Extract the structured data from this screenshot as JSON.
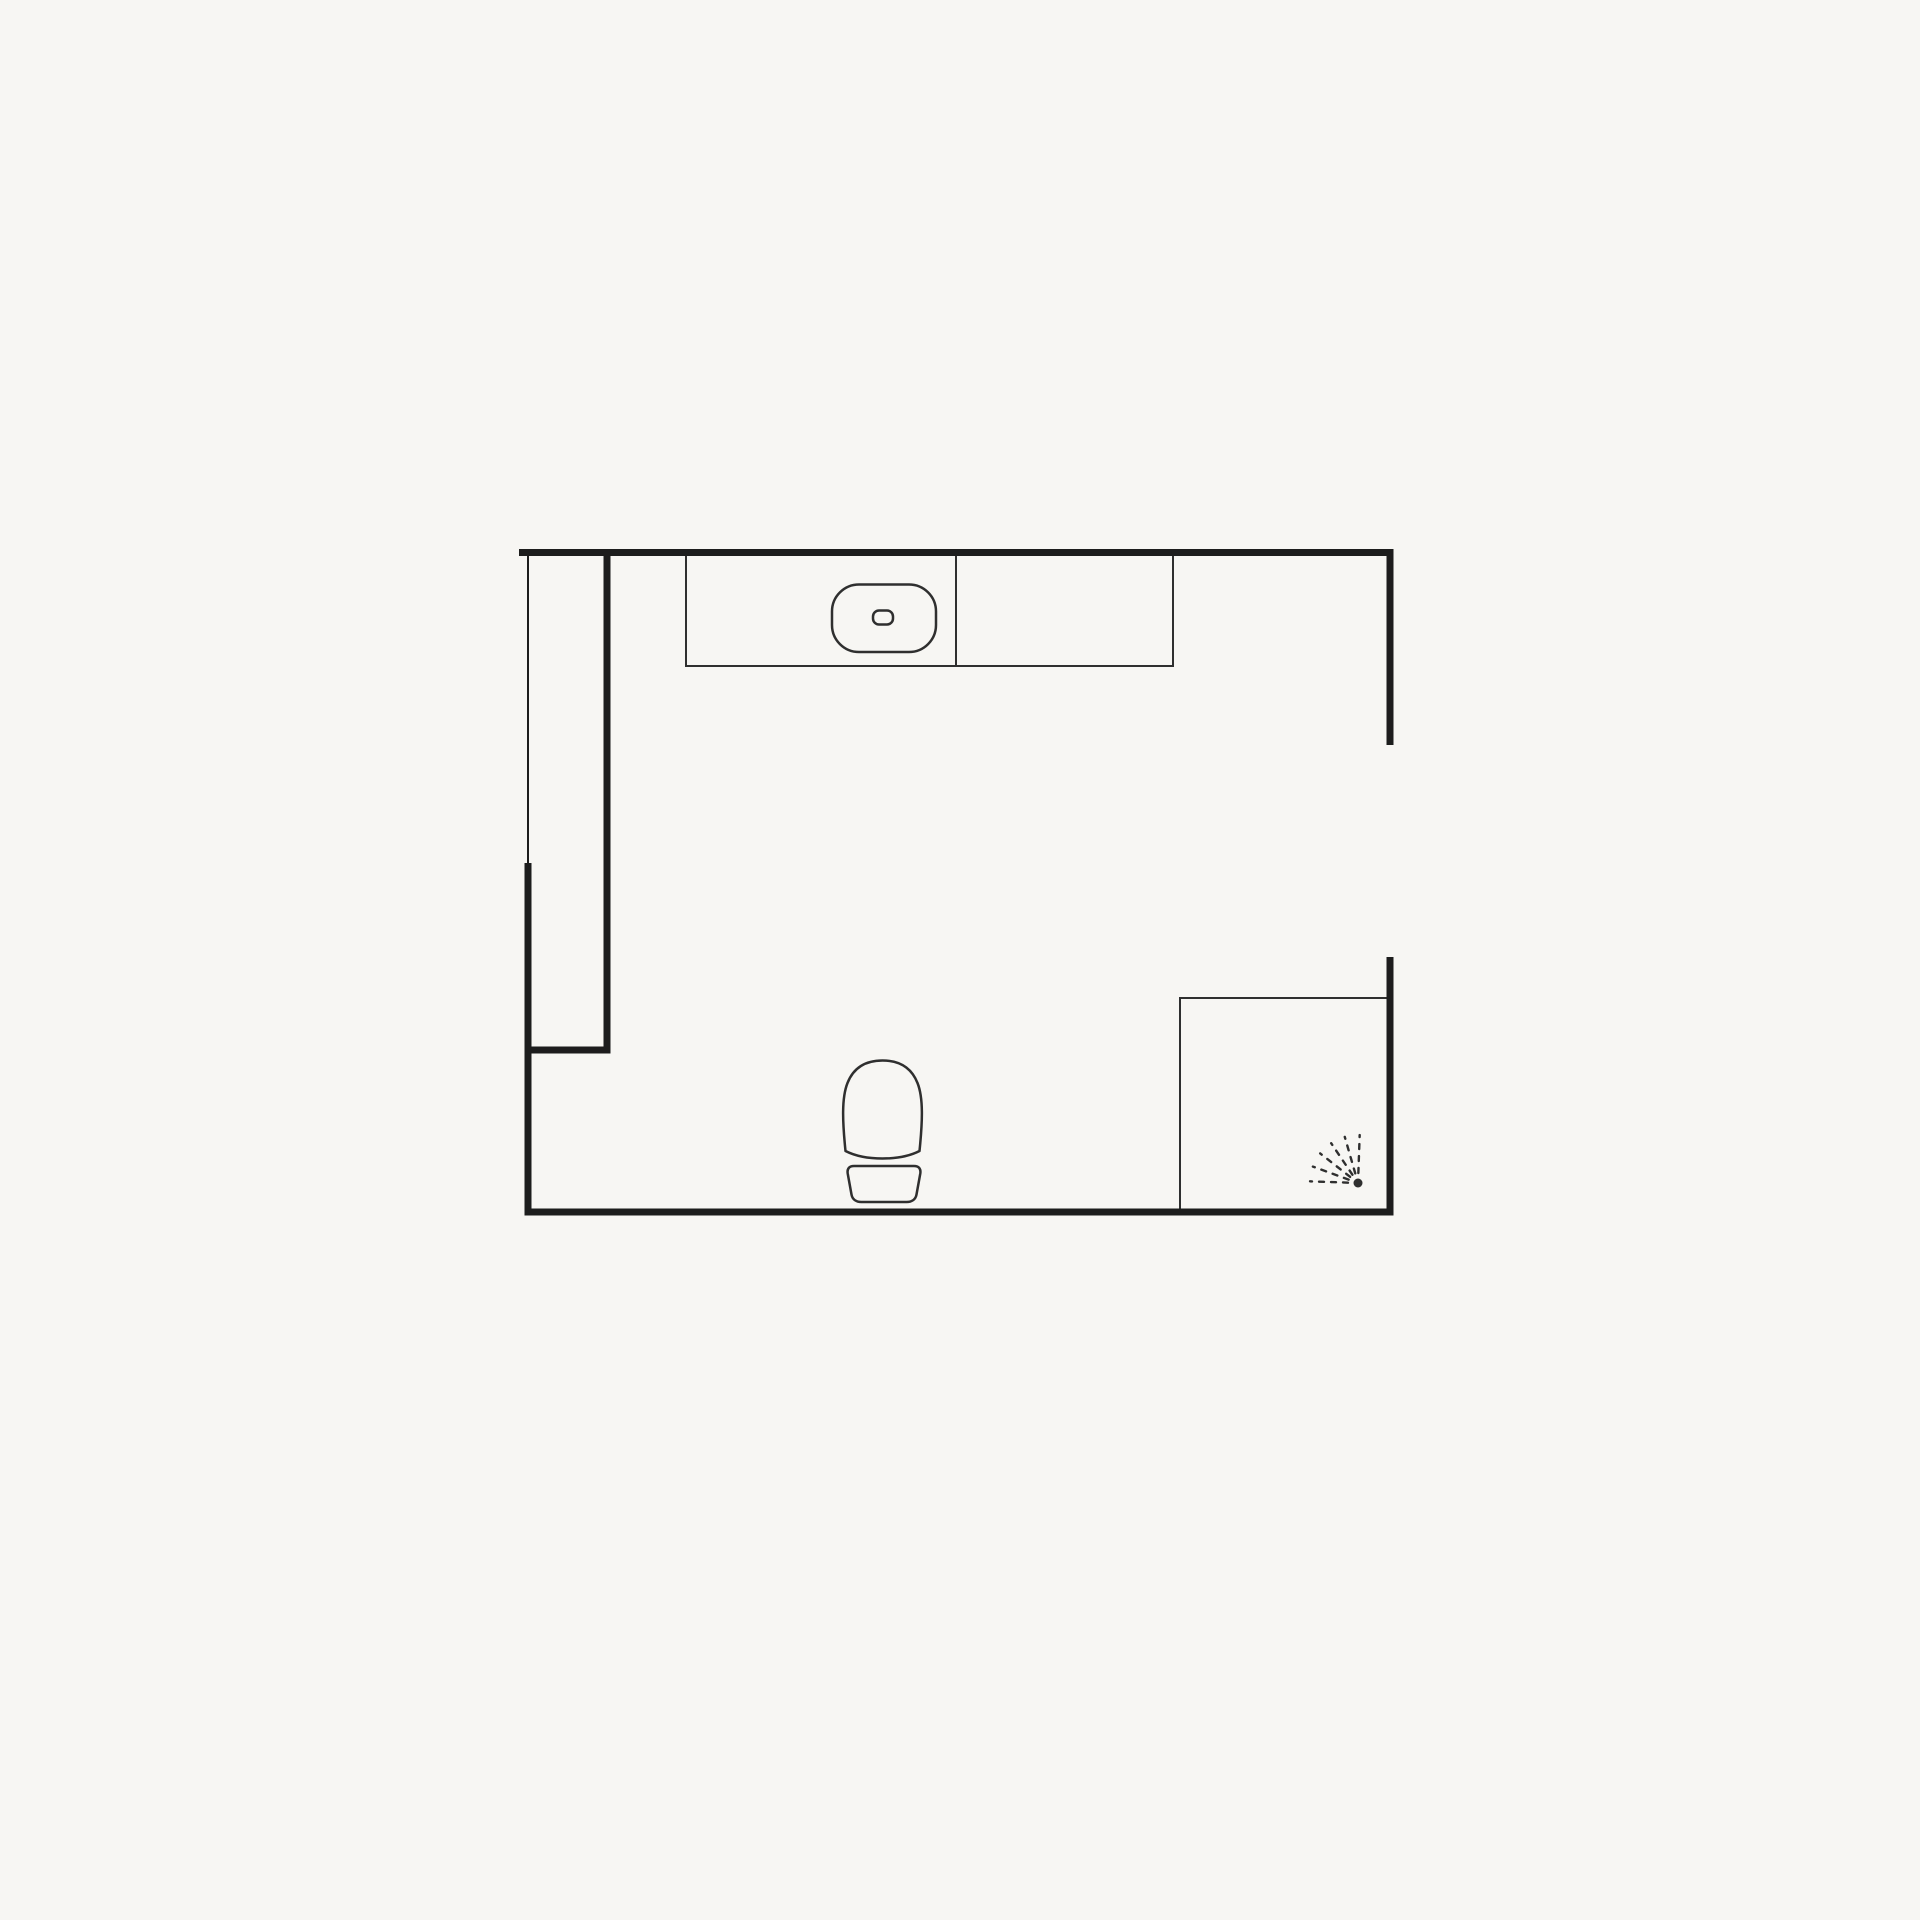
{
  "page": {
    "background": "#f7f6f3",
    "wall_color": "#1d1d1d",
    "fixture_color": "#2f2f2f"
  },
  "floorplan": {
    "canvas": {
      "width": 1920,
      "height": 1920
    },
    "walls": [
      {
        "name": "top-wall",
        "type": "line",
        "x1": 519,
        "y1": 552.5,
        "x2": 1393.5,
        "y2": 552.5,
        "w": 7
      },
      {
        "name": "right-wall-upper",
        "type": "line",
        "x1": 1390,
        "y1": 549,
        "x2": 1390,
        "y2": 745,
        "w": 7
      },
      {
        "name": "right-wall-lower",
        "type": "line",
        "x1": 1390,
        "y1": 957,
        "x2": 1390,
        "y2": 1215.5,
        "w": 7
      },
      {
        "name": "bottom-wall",
        "type": "line",
        "x1": 524.5,
        "y1": 1212,
        "x2": 1393.5,
        "y2": 1212,
        "w": 7
      },
      {
        "name": "left-wall-thin-upper",
        "type": "line",
        "x1": 528,
        "y1": 549,
        "x2": 528,
        "y2": 866,
        "w": 2
      },
      {
        "name": "left-wall-thick-lower",
        "type": "line",
        "x1": 528,
        "y1": 863,
        "x2": 528,
        "y2": 1215.5,
        "w": 7
      },
      {
        "name": "partition-wall",
        "type": "line",
        "x1": 607,
        "y1": 549,
        "x2": 607,
        "y2": 1053.5,
        "w": 7
      },
      {
        "name": "partition-wall-return",
        "type": "line",
        "x1": 524.5,
        "y1": 1050,
        "x2": 610.5,
        "y2": 1050,
        "w": 7
      }
    ],
    "fixtures": [
      {
        "name": "vanity-counter",
        "type": "rect",
        "x": 686,
        "y": 553,
        "width": 487,
        "height": 113,
        "w": 2
      },
      {
        "name": "vanity-divider",
        "type": "line",
        "x1": 956,
        "y1": 553,
        "x2": 956,
        "y2": 666,
        "w": 2
      },
      {
        "name": "sink-basin",
        "type": "rect",
        "x": 832,
        "y": 584.5,
        "width": 104,
        "height": 67.5,
        "rx": 27,
        "w": 2.5
      },
      {
        "name": "sink-drain",
        "type": "rect",
        "x": 873,
        "y": 610.5,
        "width": 20,
        "height": 14,
        "rx": 6,
        "w": 2.5
      },
      {
        "name": "toilet-bowl",
        "type": "path",
        "w": 2.5,
        "d": "M845.5 1151 C842.5 1122 841.5 1098 847.5 1083 C854 1066.5 867 1060.5 882.5 1060.5 C898 1060.5 911 1066.5 917.5 1083 C923.5 1098 922.5 1122 919.5 1151 C900 1161 865 1161 845.5 1151 Z"
      },
      {
        "name": "toilet-tank",
        "type": "path",
        "w": 2.5,
        "d": "M854 1166 L914 1166 C919 1166 921 1169 920.3 1173.5 L916.5 1194.5 C915.6 1199.5 911.7 1202 906.7 1202 L861.3 1202 C856.3 1202 852.4 1199.5 851.5 1194.5 L847.7 1173.5 C847 1169 849 1166 854 1166 Z"
      },
      {
        "name": "shower-enclosure",
        "type": "rect",
        "x": 1180,
        "y": 998,
        "width": 210,
        "height": 214,
        "w": 2
      },
      {
        "name": "shower-spray",
        "type": "spray",
        "cx": 1358,
        "cy": 1183,
        "dot_r": 4.5,
        "inner": 10,
        "outer": 48,
        "angles": [
          88,
          106,
          124,
          142,
          160,
          178
        ],
        "dash": "5 7",
        "w": 2.4
      }
    ]
  }
}
